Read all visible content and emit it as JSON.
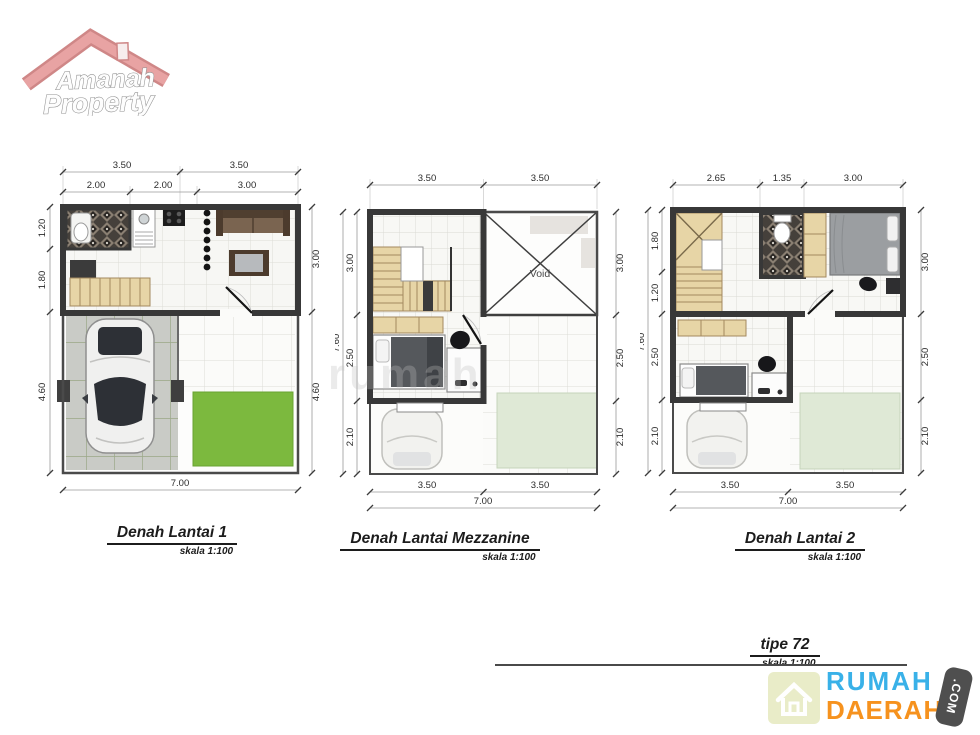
{
  "amanah_logo": {
    "line1": "Amanah",
    "line2": "Property"
  },
  "watermark": {
    "text": "rumah"
  },
  "plan1": {
    "title": "Denah Lantai 1",
    "scale": "skala 1:100",
    "dims": {
      "t1a": "3.50",
      "t1b": "3.50",
      "t2a": "2.00",
      "t2b": "2.00",
      "t2c": "3.00",
      "l1": "1.20",
      "l2": "1.80",
      "l3": "4.60",
      "r1": "3.00",
      "r2": "4.60",
      "b1": "7.00"
    }
  },
  "plan2": {
    "title": "Denah Lantai Mezzanine",
    "scale": "skala 1:100",
    "void_label": "Void",
    "dims": {
      "t1": "3.50",
      "t2": "3.50",
      "lo": "7.60",
      "l1": "3.00",
      "l2": "2.50",
      "l3": "2.10",
      "r1": "3.00",
      "r2": "2.50",
      "r3": "2.10",
      "b1": "3.50",
      "b2": "3.50",
      "b3": "7.00"
    }
  },
  "plan3": {
    "title": "Denah Lantai 2",
    "scale": "skala 1:100",
    "dims": {
      "t1": "2.65",
      "t2": "1.35",
      "t3": "3.00",
      "lo": "7.60",
      "l1": "1.80",
      "l2": "1.20",
      "l3": "2.50",
      "l4": "2.10",
      "r1": "3.00",
      "r2": "2.50",
      "r3": "2.10",
      "b1": "3.50",
      "b2": "3.50",
      "b3": "7.00"
    }
  },
  "footer": {
    "type_label": "tipe 72",
    "scale": "skala 1:100"
  },
  "brand": {
    "word1": "RUMAH",
    "word2": "DAERAH",
    "tld": ".COM"
  },
  "colors": {
    "wall": "#3a3a3a",
    "stair_wood": "#e7d5a6",
    "grass": "#7cb93e",
    "pale_grass": "#dfe9d6",
    "logo_pink": "#e8a3a3",
    "brand_blue": "#39b1e8",
    "brand_orange": "#f6921e",
    "dim_text": "#2b2b2b"
  }
}
